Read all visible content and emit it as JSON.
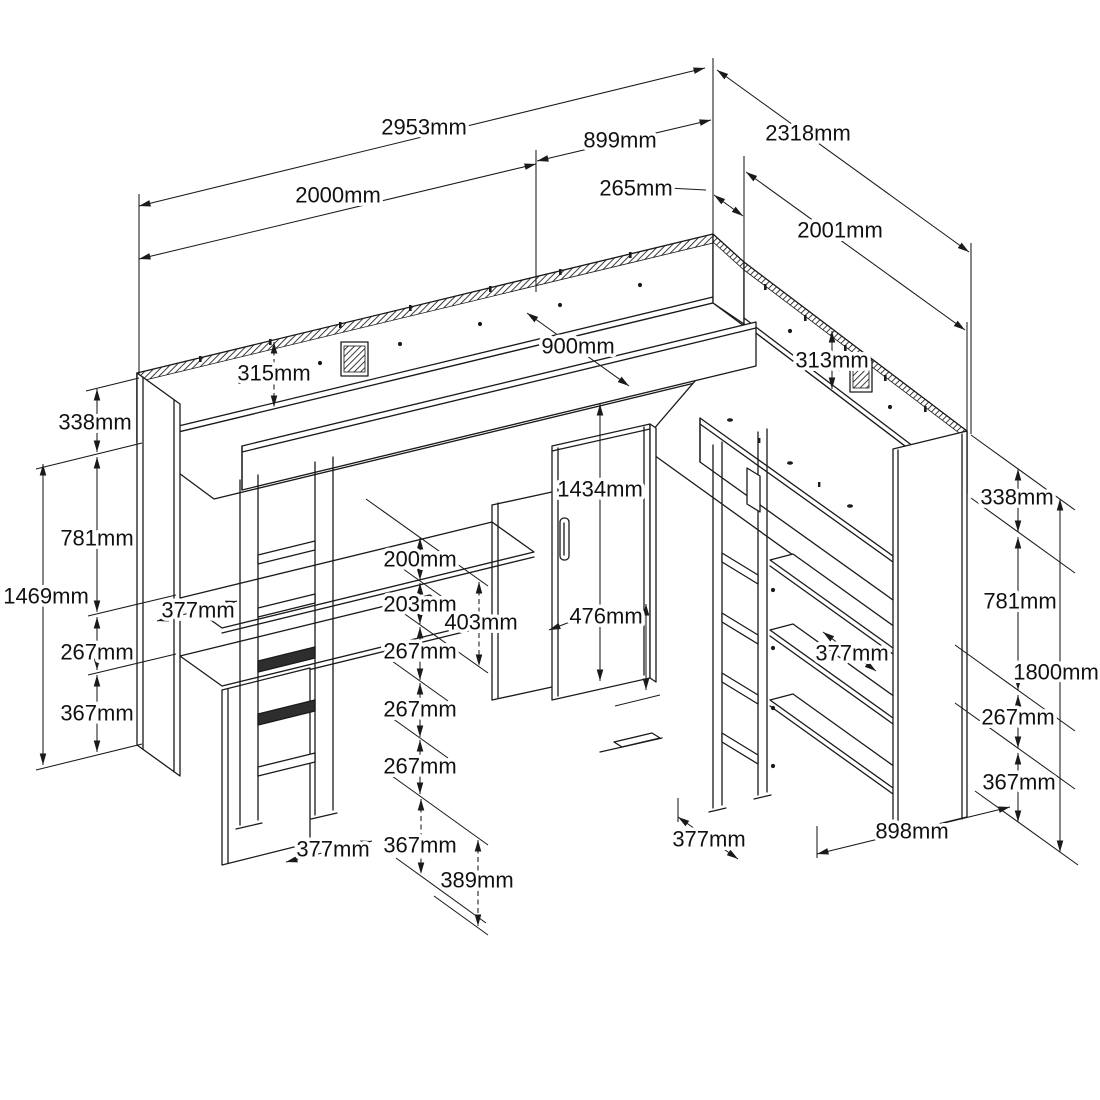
{
  "figure": {
    "type": "isometric furniture assembly dimension drawing",
    "subject": "corner loft bed unit with two beds, desks, shelves, ladders and wardrobe",
    "unit": "mm"
  },
  "labels": {
    "d2953": "2953mm",
    "d899": "899mm",
    "d2318": "2318mm",
    "d265": "265mm",
    "d2000": "2000mm",
    "d2001": "2001mm",
    "d315": "315mm",
    "d900": "900mm",
    "d313": "313mm",
    "d338L": "338mm",
    "d781L": "781mm",
    "d1469": "1469mm",
    "d267L": "267mm",
    "d367L": "367mm",
    "d377Lshelf": "377mm",
    "d200": "200mm",
    "d203": "203mm",
    "d403": "403mm",
    "d267M1": "267mm",
    "d267M2": "267mm",
    "d267M3": "267mm",
    "d367M": "367mm",
    "d389": "389mm",
    "d377Lbottom": "377mm",
    "d1434": "1434mm",
    "d476": "476mm",
    "d377Mbottom": "377mm",
    "d338R": "338mm",
    "d781R": "781mm",
    "d1800": "1800mm",
    "d377Rshelf": "377mm",
    "d267R": "267mm",
    "d367R": "367mm",
    "d898": "898mm"
  }
}
